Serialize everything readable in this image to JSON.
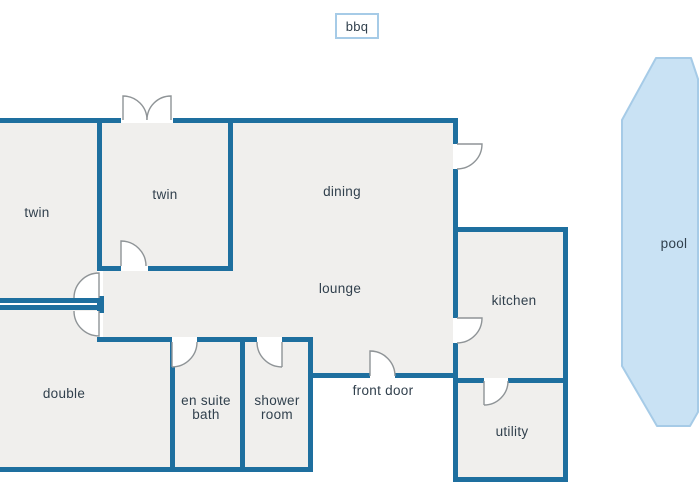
{
  "rooms": {
    "twin_left": {
      "label": "twin"
    },
    "twin_middle": {
      "label": "twin"
    },
    "dining": {
      "label": "dining"
    },
    "lounge": {
      "label": "lounge"
    },
    "kitchen": {
      "label": "kitchen"
    },
    "double": {
      "label": "double"
    },
    "en_suite_bath": {
      "label": "en suite\nbath"
    },
    "shower_room": {
      "label": "shower\nroom"
    },
    "utility": {
      "label": "utility"
    }
  },
  "outdoor": {
    "pool": {
      "label": "pool"
    },
    "bbq": {
      "label": "bbq"
    }
  },
  "annotations": {
    "front_door": {
      "label": "front door"
    }
  },
  "colors": {
    "wall": "#1e6f9f",
    "room-fill": "#f0efed",
    "door-stroke": "#8f9497",
    "pool-fill": "#c9e2f4",
    "pool-stroke": "#a6cbe7",
    "bbq-border": "#a6cbe7",
    "text": "#31404d"
  }
}
